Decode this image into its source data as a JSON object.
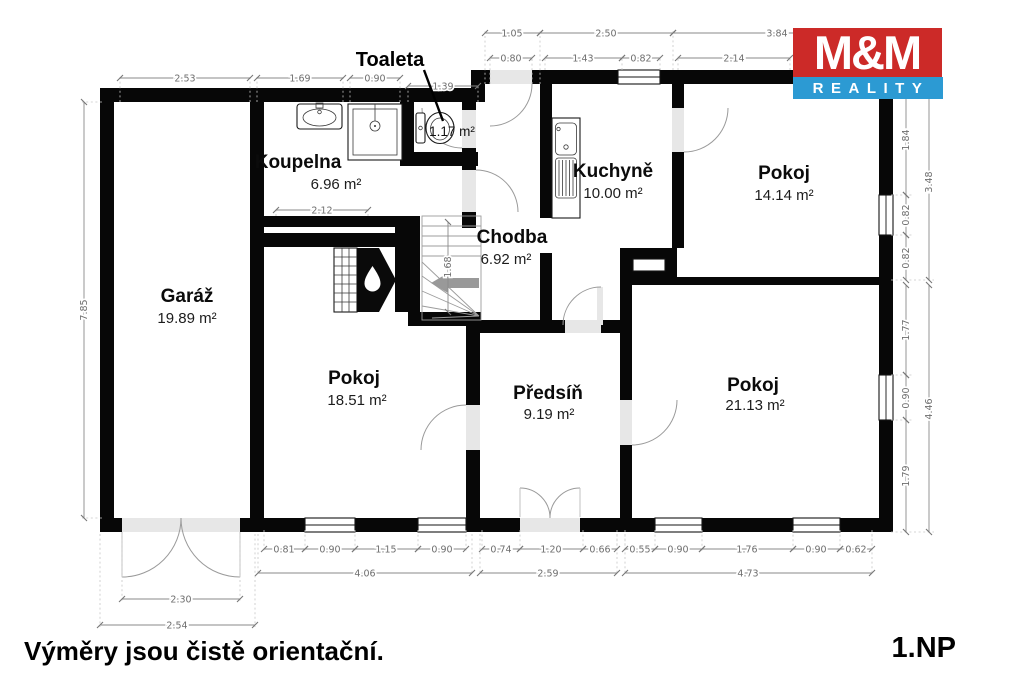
{
  "footer": {
    "disclaimer": "Výměry jsou čistě orientační.",
    "floor": "1.NP"
  },
  "logo": {
    "top": "M&M",
    "bottom": "REALITY",
    "red": "#cc2a28",
    "blue": "#2c9ad3"
  },
  "rooms": {
    "garaz": {
      "name": "Garáž",
      "area": "19.89 m²"
    },
    "koupelna": {
      "name": "Koupelna",
      "area": "6.96 m²"
    },
    "toaleta": {
      "name": "Toaleta",
      "area": "1.17 m²"
    },
    "chodba": {
      "name": "Chodba",
      "area": "6.92 m²"
    },
    "kuchyne": {
      "name": "Kuchyně",
      "area": "10.00 m²"
    },
    "pokoj1": {
      "name": "Pokoj",
      "area": "14.14 m²"
    },
    "pokoj2": {
      "name": "Pokoj",
      "area": "18.51 m²"
    },
    "predsin": {
      "name": "Předsíň",
      "area": "9.19 m²"
    },
    "pokoj3": {
      "name": "Pokoj",
      "area": "21.13 m²"
    }
  },
  "dims": {
    "top_row1": [
      "1.05",
      "2.50",
      "3.84"
    ],
    "top_row2": [
      "0.80",
      "1.43",
      "0.82",
      "2.14"
    ],
    "top_left": [
      "2.53",
      "1.69",
      "0.90",
      "1.39"
    ],
    "left_total": "7.85",
    "right_upper": [
      "1.84",
      "0.82",
      "0.82"
    ],
    "right_upper_total": "3.48",
    "right_lower": [
      "1.77",
      "0.90",
      "1.79"
    ],
    "right_lower_total": "4.46",
    "bottom_left": [
      "0.81",
      "0.90",
      "1.15",
      "0.90"
    ],
    "bottom_left_total": "4.06",
    "bottom_mid": [
      "0.74",
      "1.20",
      "0.66"
    ],
    "bottom_mid_total": "2.59",
    "bottom_right": [
      "0.55",
      "0.90",
      "1.76",
      "0.90",
      "0.62"
    ],
    "bottom_right_total": "4.73",
    "garage_door_width": "2.30",
    "garage_total": "2.54",
    "interior_width": "2.12",
    "interior_height": "1.68"
  }
}
